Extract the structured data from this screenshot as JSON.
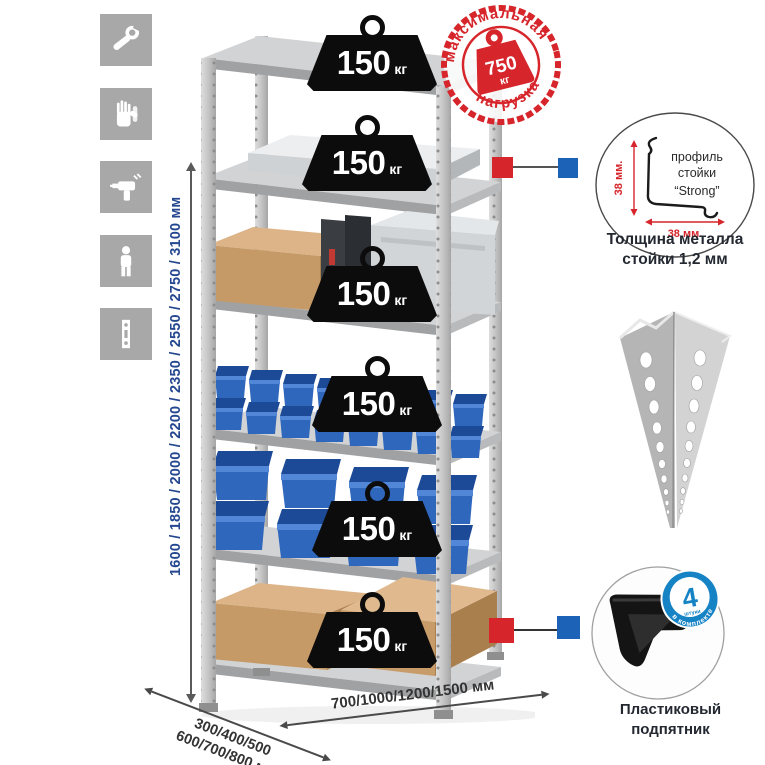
{
  "side_icons": [
    {
      "name": "wrench-icon"
    },
    {
      "name": "gloves-icon"
    },
    {
      "name": "drill-icon"
    },
    {
      "name": "person-icon"
    },
    {
      "name": "post-profile-icon"
    }
  ],
  "dimensions": {
    "height": "1600 / 1850 / 2000 / 2200 / 2350 / 2550 / 2750 / 3100 мм",
    "depth_line1": "300/400/500",
    "depth_line2": "600/700/800 мм",
    "width": "700/1000/1200/1500 мм"
  },
  "shelf_badges": [
    {
      "value": "150",
      "unit": "кг"
    },
    {
      "value": "150",
      "unit": "кг"
    },
    {
      "value": "150",
      "unit": "кг"
    },
    {
      "value": "150",
      "unit": "кг"
    },
    {
      "value": "150",
      "unit": "кг"
    },
    {
      "value": "150",
      "unit": "кг"
    }
  ],
  "max_load_stamp": {
    "arc_top": "максимальная",
    "arc_bottom": "нагрузка",
    "value": "750",
    "unit": "кг"
  },
  "profile_callout": {
    "line1": "профиль",
    "line2": "стойки",
    "line3": "“Strong”",
    "dim_vertical": "38 мм.",
    "dim_horizontal": "38 мм.",
    "caption1": "Толщина металла",
    "caption2": "стойки 1,2 мм"
  },
  "foot_callout": {
    "count": "4",
    "count_sub": "штуки",
    "arc_text": "в комплекте",
    "caption1": "Пластиковый",
    "caption2": "подпятник"
  },
  "colors": {
    "stamp_red": "#d6252b",
    "callout_red": "#d6252b",
    "callout_blue": "#1c63b7",
    "dimension_blue": "#24478f",
    "badge_black": "#0c0c0c",
    "bin_blue": "#2f67bd",
    "icon_gray": "#a8a8a8"
  }
}
